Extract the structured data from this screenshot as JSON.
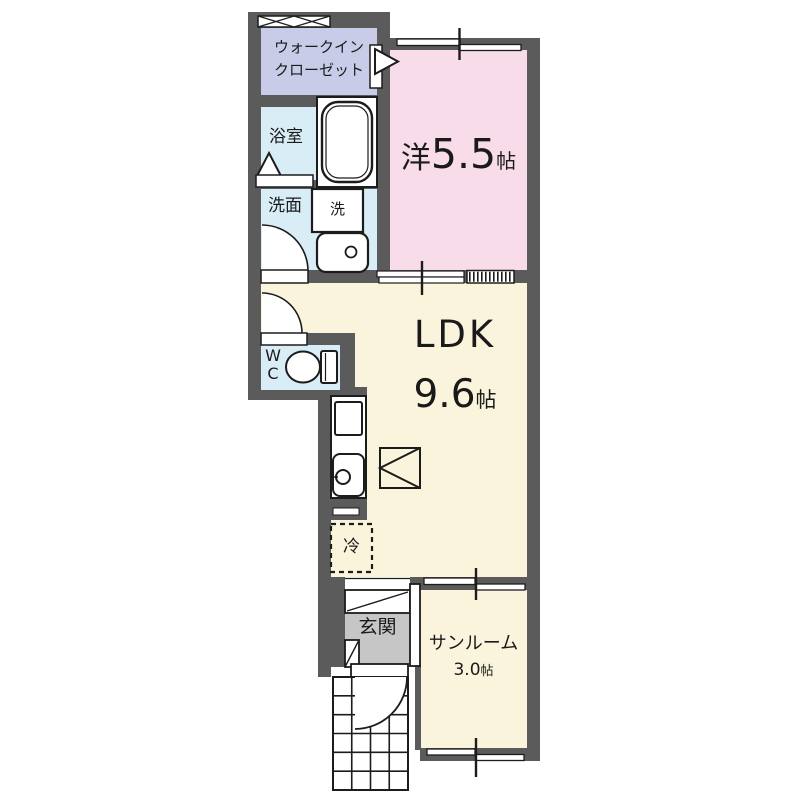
{
  "plan": {
    "type": "floor-plan",
    "rooms": {
      "wic": {
        "label_line1": "ウォークイン",
        "label_line2": "クローゼット",
        "color": "#c9cce9"
      },
      "bath": {
        "label": "浴室",
        "color": "#d9edf7"
      },
      "washroom": {
        "label": "洗面",
        "color": "#d9edf7"
      },
      "washer": {
        "label": "洗"
      },
      "wc": {
        "label_line1": "W",
        "label_line2": "C",
        "color": "#d9edf7"
      },
      "bedroom": {
        "prefix": "洋",
        "size": "5.5",
        "unit": "帖",
        "color": "#f9dcea"
      },
      "ldk": {
        "label": "LDK",
        "size": "9.6",
        "unit": "帖",
        "color": "#faf4dc"
      },
      "fridge": {
        "label": "冷"
      },
      "entrance": {
        "label": "玄関",
        "color": "#c6c6c6"
      },
      "sunroom": {
        "label": "サンルーム",
        "size": "3.0",
        "unit": "帖",
        "color": "#faf4dc"
      }
    },
    "colors": {
      "wall": "#5b5b5b",
      "line": "#1c1c1c",
      "background": "#ffffff",
      "fixture_fill": "#ffffff"
    }
  }
}
